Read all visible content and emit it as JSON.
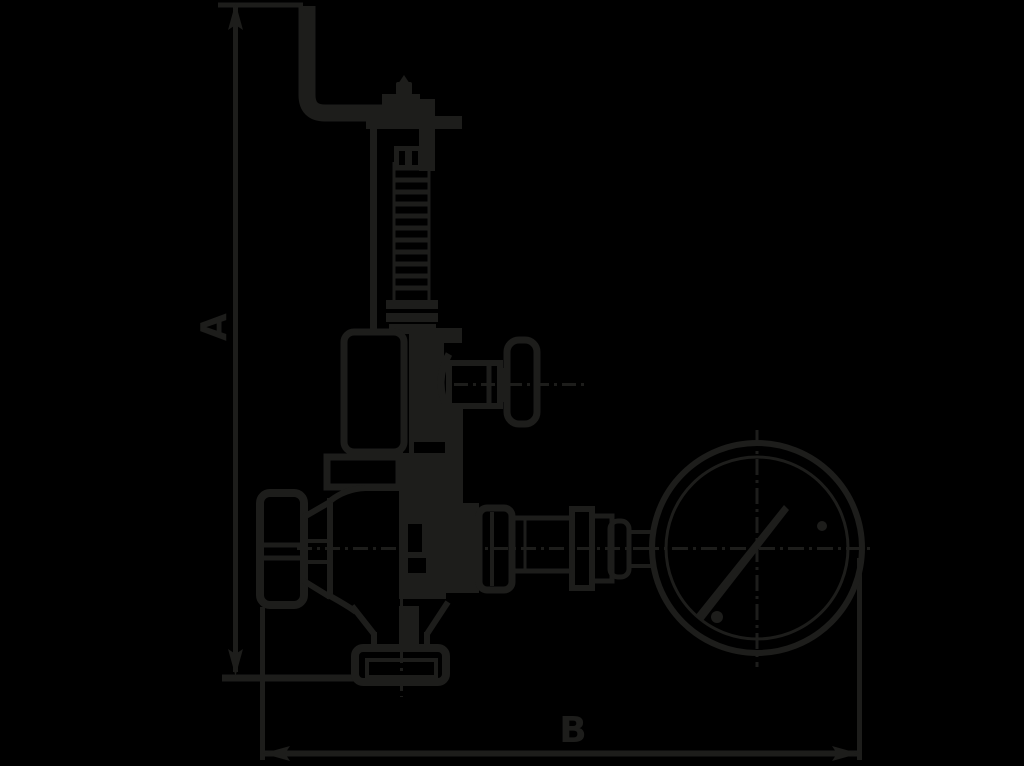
{
  "figure": {
    "type": "technical-drawing",
    "subject": "safety relief valve with test lever, shut-off handwheels and pressure gauge",
    "view": "side elevation outline drawing"
  },
  "colors": {
    "background": "#000000",
    "line": "#1d1d1b"
  },
  "dimensions": {
    "vertical": {
      "label": "A",
      "orientation": "vertical",
      "side": "left"
    },
    "horizontal": {
      "label": "B",
      "orientation": "horizontal",
      "side": "bottom"
    }
  },
  "components": {
    "lever": "test-lever",
    "cap": "adjustment-cap",
    "spring": "spring-column",
    "housing": "spring-housing",
    "bonnet": "bonnet-flange",
    "side_valve": "gauge-shutoff-valve",
    "left_wheel": "inlet-handwheel",
    "body": "valve-body",
    "inlet": "inlet-flange",
    "fittings": "gauge-fittings",
    "gauge": "pressure-gauge"
  }
}
